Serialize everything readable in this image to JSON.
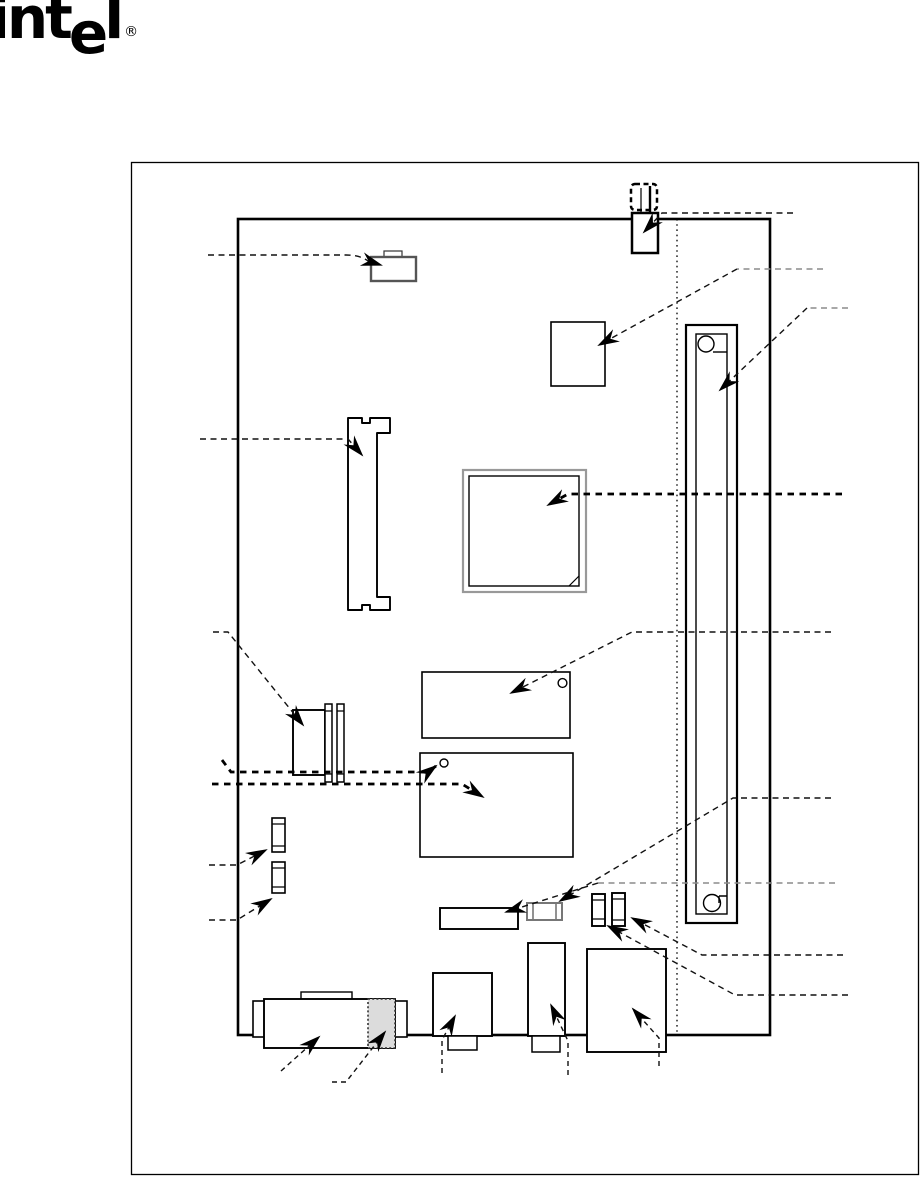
{
  "page": {
    "background": "#ffffff"
  },
  "logo": {
    "part_int": "int",
    "part_e": "e",
    "part_l": "l",
    "registered": "®",
    "color": "#000000"
  },
  "diagram": {
    "type": "motherboard-component-location-diagram",
    "colors": {
      "outline": "#000000",
      "gray_outline": "#8a8a8a",
      "callout": "#111111",
      "callout_gray": "#8c8c8c",
      "shaded_fill": "#dcdcdc",
      "board_fill": "#ffffff"
    },
    "components": [
      "speaker-component",
      "battery-holder",
      "square-chip",
      "expansion-slot",
      "dimm-socket",
      "processor-chip",
      "flash-chip",
      "controller-chip",
      "floppy-connector",
      "capacitor-1",
      "capacitor-2",
      "front-panel-header",
      "ir-header",
      "jumper-1",
      "jumper-2",
      "stacked-rear-connector",
      "shaded-connector-section",
      "rear-connector-1",
      "rear-connector-2",
      "rear-connector-3"
    ],
    "callout_count": 19
  }
}
